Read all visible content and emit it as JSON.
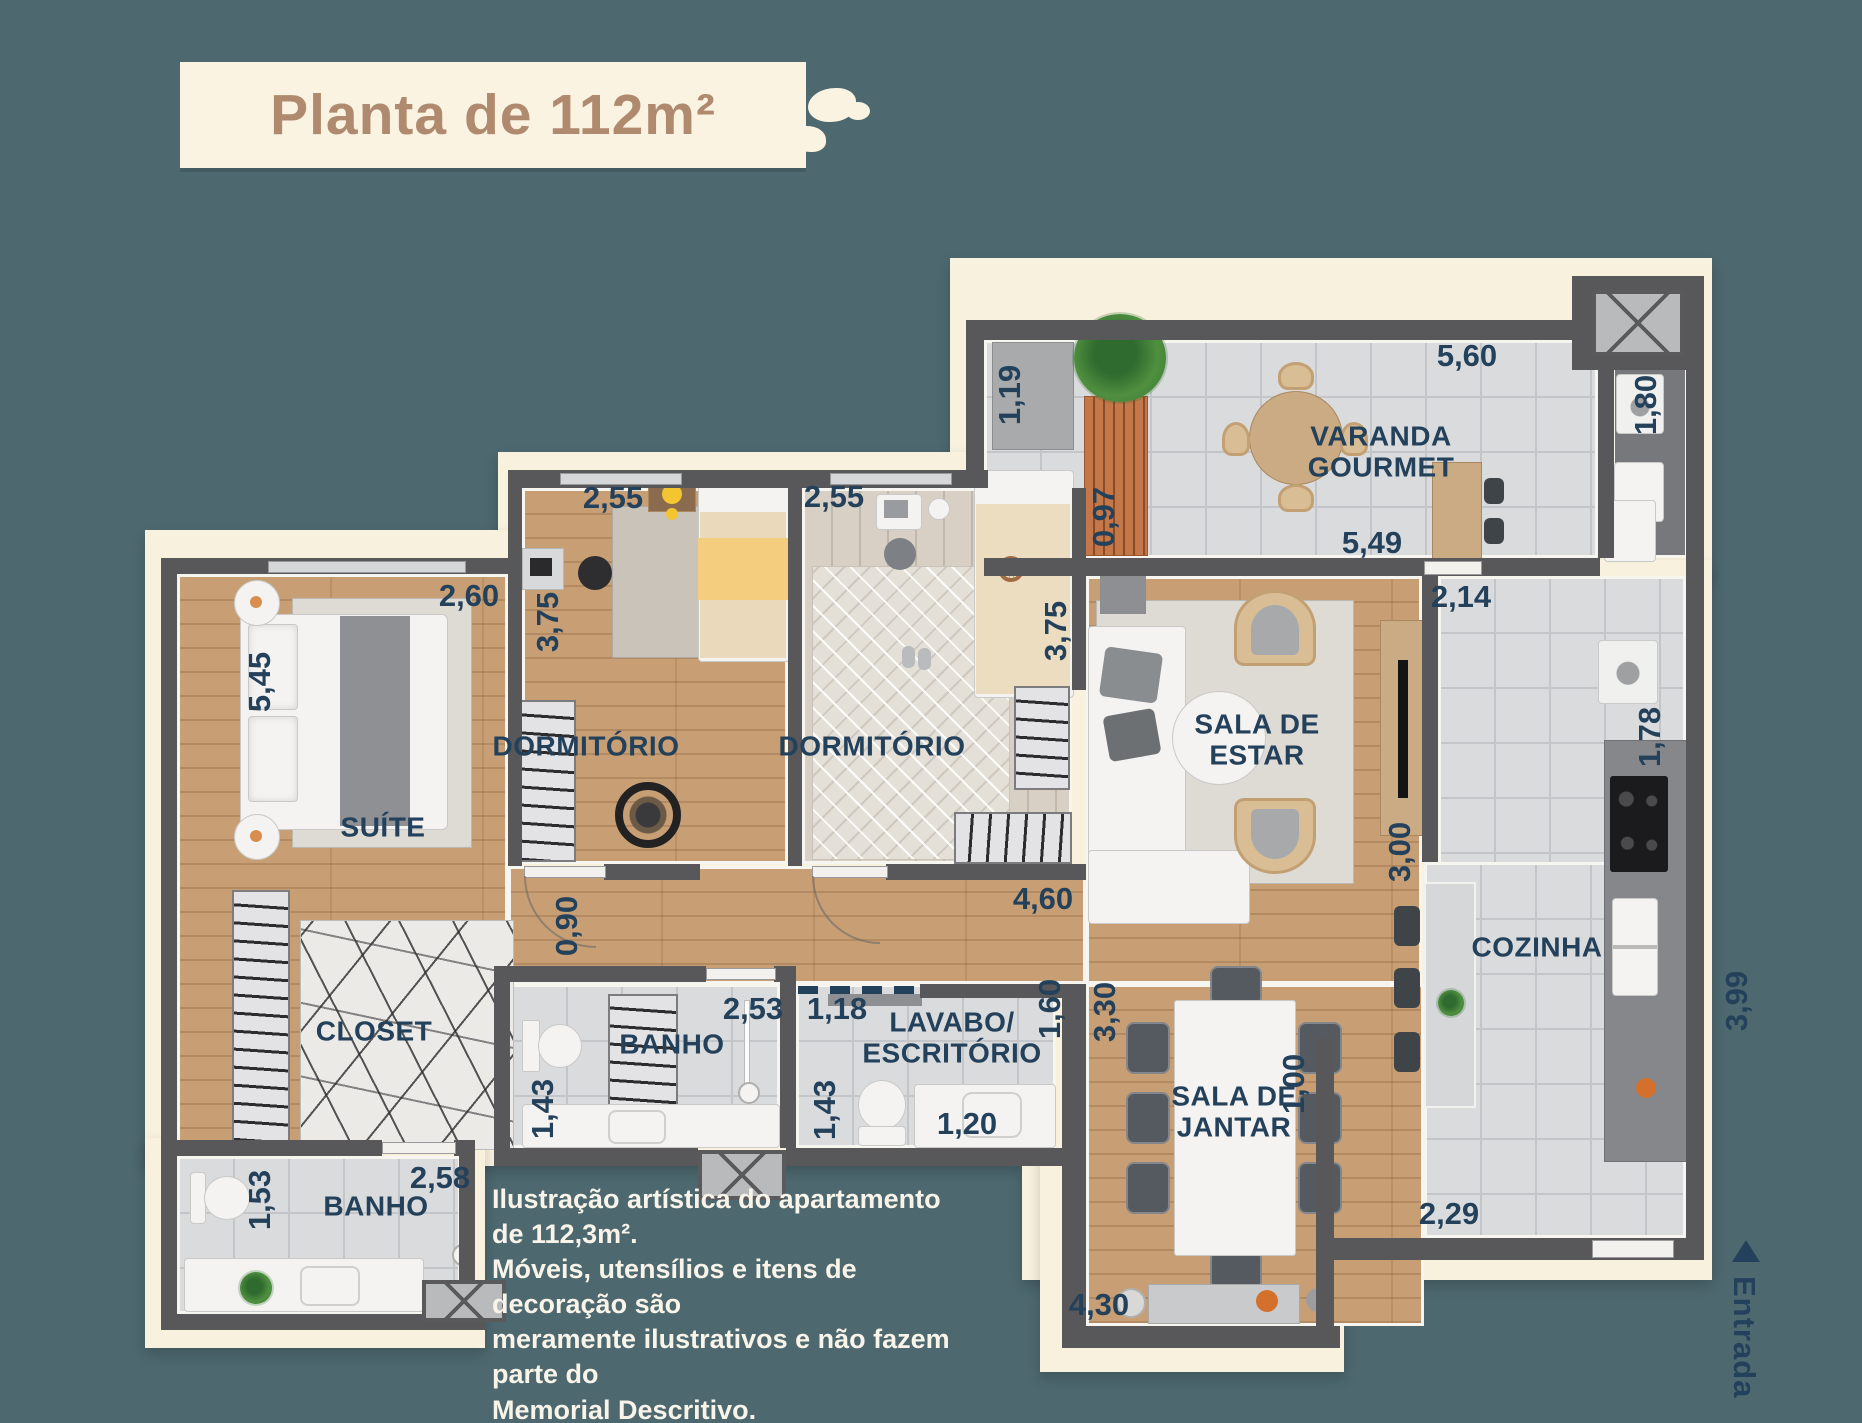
{
  "title": "Planta de 112m²",
  "disclaimer": "Ilustração artística do apartamento de 112,3m².\nMóveis, utensílios e itens de decoração são\nmeramente ilustrativos e não fazem parte do\nMemorial Descritivo.",
  "entrance_label": "Entrada",
  "colors": {
    "background": "#4d686f",
    "plate": "#f8f1de",
    "wall": "#58585a",
    "label_navy": "#24415c",
    "title_brown": "#b08a6e",
    "wood_floor": "#c89f74",
    "tile_floor": "#dadbdd"
  },
  "rooms": {
    "varanda": "VARANDA\nGOURMET",
    "dorm1": "DORMITÓRIO",
    "dorm2": "DORMITÓRIO",
    "suite": "SUÍTE",
    "living": "SALA DE\nESTAR",
    "kitchen": "COZINHA",
    "dining": "SALA DE\nJANTAR",
    "closet": "CLOSET",
    "bath_suite": "BANHO",
    "lavabo": "LAVABO/\nESCRITÓRIO",
    "bath_social": "BANHO"
  },
  "dimensions": {
    "varanda_width_top": "5,60",
    "varanda_depth_left": "1,19",
    "varanda_bench": "0,97",
    "varanda_width_bottom": "5,49",
    "service_length": "1,80",
    "dorm1_width": "2,55",
    "dorm1_depth": "3,75",
    "dorm2_width": "2,55",
    "dorm2_depth": "3,75",
    "suite_width": "2,60",
    "suite_depth": "5,45",
    "kitchen_top_width": "2,14",
    "kitchen_upper_depth": "1,78",
    "living_width": "3,00",
    "hall_width": "4,60",
    "corridor_width": "0,90",
    "bath_suite_width": "2,53",
    "bath_suite_depth": "1,43",
    "lavabo_width": "1,18",
    "lavabo_depth": "1,43",
    "lavabo_sink": "1,20",
    "dining_wall_upper": "1,60",
    "dining_depth": "3,30",
    "bath_social_width": "2,58",
    "bath_social_depth": "1,53",
    "dining_width_bottom": "4,30",
    "dining_wall_lower": "1,00",
    "kitchen_bottom_width": "2,29",
    "kitchen_right_depth": "3,99"
  }
}
